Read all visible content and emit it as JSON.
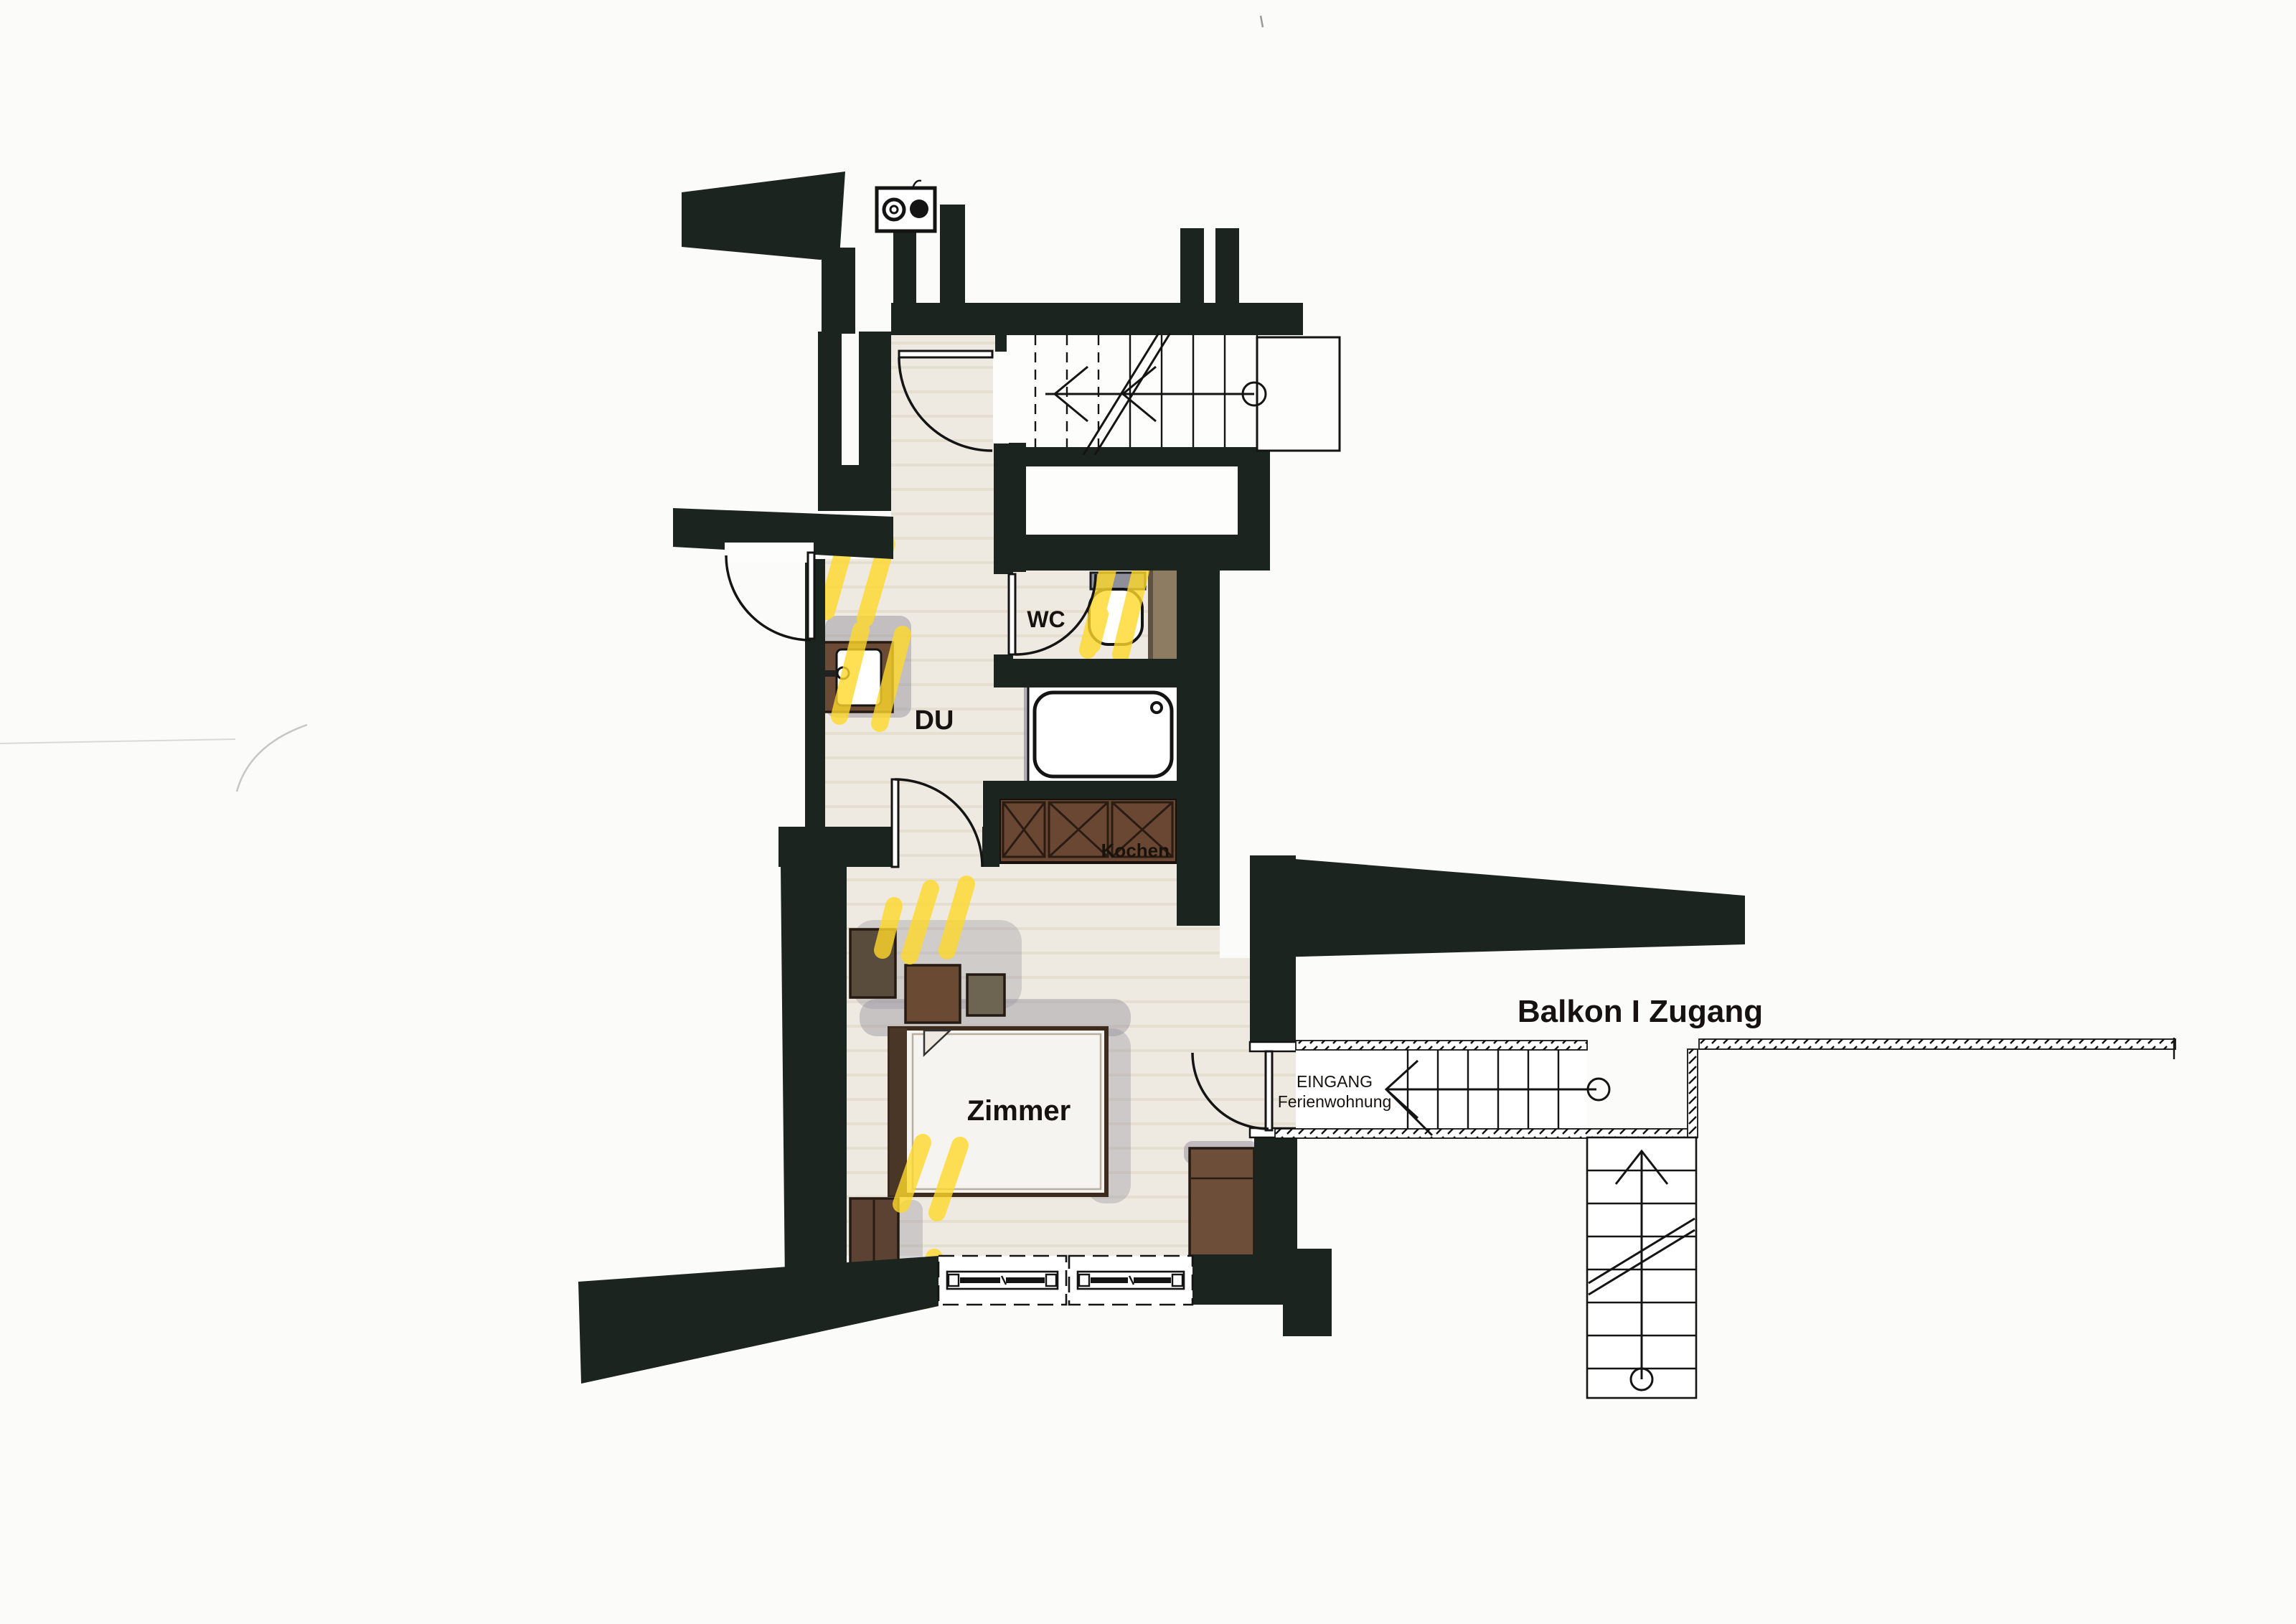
{
  "document": {
    "kind": "scanned architectural floor plan of a holiday apartment"
  },
  "labels": {
    "du": "DU",
    "wc": "WC",
    "zimmer": "Zimmer",
    "kochen": "Kochen",
    "balkon_zugang": "Balkon I Zugang",
    "eingang_line1": "EINGANG",
    "eingang_line2": "Ferienwohnung"
  },
  "colors": {
    "wall": "#1c2420",
    "paper": "#fbfbf9",
    "floor": "#efeae1",
    "floor_stripe": "#e2dccd",
    "furniture_brown": "#6b4a36",
    "furniture_dark_brown": "#4a3627",
    "tile_brown": "#8d7c62",
    "highlight_yellow": "#ffd92b",
    "marker_shadow_gray": "#8f8c9b",
    "line_black": "#141414"
  },
  "icons": {
    "chimney": "block with ring and filled circle",
    "stair_walkline": "line with arrow and start circle",
    "railing": "double line with diagonal hatching",
    "window": "dashed frame with glazing bar"
  }
}
